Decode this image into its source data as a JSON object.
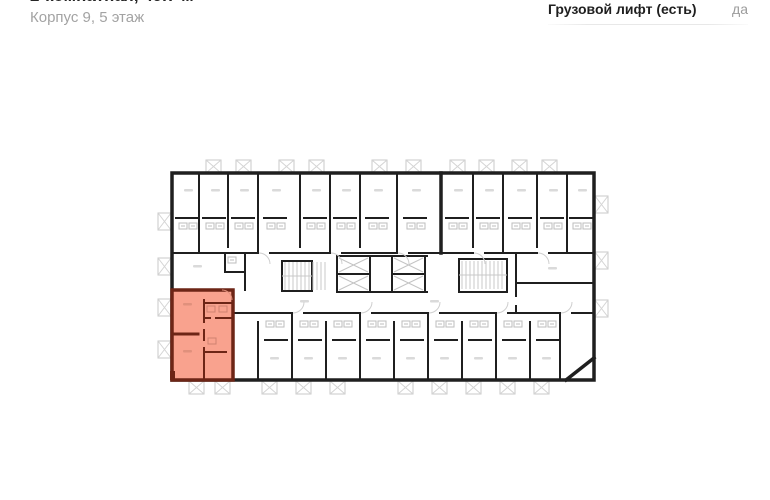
{
  "header": {
    "title": "2-комнатная, 49.7 м²",
    "subtitle": "Корпус 9, 5 этаж"
  },
  "specs": {
    "freight_elevator_label": "Грузовой лифт (есть)",
    "freight_elevator_value": "да"
  },
  "floor_plan": {
    "highlight_color": "#F9A28E",
    "highlight_wall_color": "#6D2516",
    "wall_color": "#1F1F1F",
    "fixture_color": "#C9C9C9"
  }
}
